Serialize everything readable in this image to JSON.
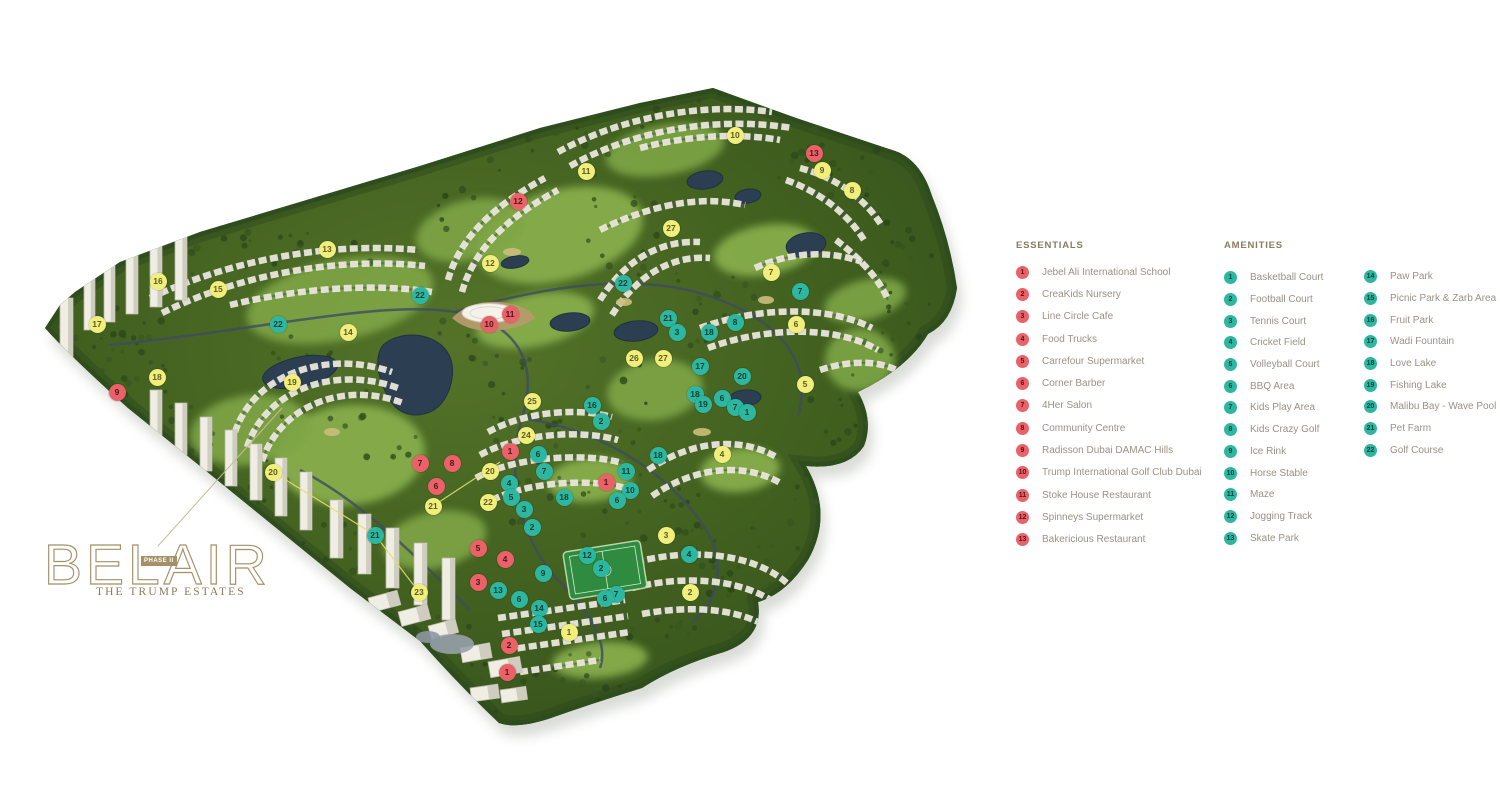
{
  "logo": {
    "name": "BELAIR",
    "phase": "PHASE II",
    "subtitle": "THE TRUMP ESTATES",
    "gold": "#a5906a",
    "subtitle_color": "#8d7a58"
  },
  "legend": {
    "header_color": "#8b7b5e",
    "essentials": {
      "title": "ESSENTIALS",
      "items": [
        {
          "n": "1",
          "label": "Jebel Ali International School"
        },
        {
          "n": "2",
          "label": "CreaKids Nursery"
        },
        {
          "n": "3",
          "label": "Line Circle Cafe"
        },
        {
          "n": "4",
          "label": "Food Trucks"
        },
        {
          "n": "5",
          "label": "Carrefour Supermarket"
        },
        {
          "n": "6",
          "label": "Corner Barber"
        },
        {
          "n": "7",
          "label": "4Her Salon"
        },
        {
          "n": "8",
          "label": "Community Centre"
        },
        {
          "n": "9",
          "label": "Radisson Dubai DAMAC Hills"
        },
        {
          "n": "10",
          "label": "Trump International Golf Club Dubai"
        },
        {
          "n": "11",
          "label": "Stoke House Restaurant"
        },
        {
          "n": "12",
          "label": "Spinneys Supermarket"
        },
        {
          "n": "13",
          "label": "Bakericious Restaurant"
        }
      ]
    },
    "amenities": {
      "title": "AMENITIES",
      "col1": [
        {
          "n": "1",
          "label": "Basketball Court"
        },
        {
          "n": "2",
          "label": "Football Court"
        },
        {
          "n": "3",
          "label": "Tennis Court"
        },
        {
          "n": "4",
          "label": "Cricket Field"
        },
        {
          "n": "5",
          "label": "Volleyball Court"
        },
        {
          "n": "6",
          "label": "BBQ Area"
        },
        {
          "n": "7",
          "label": "Kids Play Area"
        },
        {
          "n": "8",
          "label": "Kids Crazy Golf"
        },
        {
          "n": "9",
          "label": "Ice Rink"
        },
        {
          "n": "10",
          "label": "Horse Stable"
        },
        {
          "n": "11",
          "label": "Maze"
        },
        {
          "n": "12",
          "label": "Jogging Track"
        },
        {
          "n": "13",
          "label": "Skate Park"
        }
      ],
      "col2": [
        {
          "n": "14",
          "label": "Paw Park"
        },
        {
          "n": "15",
          "label": "Picnic Park & Zarb Area"
        },
        {
          "n": "16",
          "label": "Fruit Park"
        },
        {
          "n": "17",
          "label": "Wadi Fountain"
        },
        {
          "n": "18",
          "label": "Love Lake"
        },
        {
          "n": "19",
          "label": "Fishing Lake"
        },
        {
          "n": "20",
          "label": "Malibu Bay - Wave Pool"
        },
        {
          "n": "21",
          "label": "Pet Farm"
        },
        {
          "n": "22",
          "label": "Golf Course"
        }
      ]
    }
  },
  "map": {
    "marker_styles": {
      "red": {
        "bg": "#ea6168",
        "fg": "#4c191d"
      },
      "teal": {
        "bg": "#2db7a1",
        "fg": "#093f38"
      },
      "yellow": {
        "bg": "#f1ee7d",
        "fg": "#5c5c1e"
      }
    },
    "markers": [
      {
        "t": "yellow",
        "n": "16",
        "x": 158,
        "y": 281
      },
      {
        "t": "yellow",
        "n": "15",
        "x": 218,
        "y": 289
      },
      {
        "t": "yellow",
        "n": "13",
        "x": 327,
        "y": 249
      },
      {
        "t": "yellow",
        "n": "14",
        "x": 348,
        "y": 332
      },
      {
        "t": "yellow",
        "n": "17",
        "x": 97,
        "y": 324
      },
      {
        "t": "yellow",
        "n": "18",
        "x": 157,
        "y": 377
      },
      {
        "t": "yellow",
        "n": "19",
        "x": 292,
        "y": 382
      },
      {
        "t": "yellow",
        "n": "20",
        "x": 273,
        "y": 472
      },
      {
        "t": "yellow",
        "n": "12",
        "x": 490,
        "y": 263
      },
      {
        "t": "yellow",
        "n": "11",
        "x": 586,
        "y": 171
      },
      {
        "t": "yellow",
        "n": "10",
        "x": 735,
        "y": 135
      },
      {
        "t": "yellow",
        "n": "9",
        "x": 822,
        "y": 170
      },
      {
        "t": "yellow",
        "n": "8",
        "x": 852,
        "y": 190
      },
      {
        "t": "yellow",
        "n": "27",
        "x": 671,
        "y": 228
      },
      {
        "t": "yellow",
        "n": "7",
        "x": 771,
        "y": 272
      },
      {
        "t": "yellow",
        "n": "6",
        "x": 796,
        "y": 324
      },
      {
        "t": "yellow",
        "n": "5",
        "x": 805,
        "y": 384
      },
      {
        "t": "yellow",
        "n": "26",
        "x": 634,
        "y": 358
      },
      {
        "t": "yellow",
        "n": "27",
        "x": 663,
        "y": 358
      },
      {
        "t": "yellow",
        "n": "25",
        "x": 532,
        "y": 401
      },
      {
        "t": "yellow",
        "n": "24",
        "x": 526,
        "y": 435
      },
      {
        "t": "yellow",
        "n": "4",
        "x": 722,
        "y": 454
      },
      {
        "t": "yellow",
        "n": "22",
        "x": 488,
        "y": 502
      },
      {
        "t": "yellow",
        "n": "21",
        "x": 433,
        "y": 506
      },
      {
        "t": "yellow",
        "n": "20",
        "x": 490,
        "y": 471
      },
      {
        "t": "yellow",
        "n": "23",
        "x": 419,
        "y": 592
      },
      {
        "t": "yellow",
        "n": "3",
        "x": 666,
        "y": 535
      },
      {
        "t": "yellow",
        "n": "2",
        "x": 690,
        "y": 592
      },
      {
        "t": "yellow",
        "n": "1",
        "x": 569,
        "y": 632
      },
      {
        "t": "teal",
        "n": "22",
        "x": 278,
        "y": 324
      },
      {
        "t": "teal",
        "n": "22",
        "x": 420,
        "y": 295
      },
      {
        "t": "teal",
        "n": "22",
        "x": 623,
        "y": 283
      },
      {
        "t": "teal",
        "n": "21",
        "x": 668,
        "y": 318
      },
      {
        "t": "teal",
        "n": "21",
        "x": 375,
        "y": 535
      },
      {
        "t": "teal",
        "n": "8",
        "x": 735,
        "y": 322
      },
      {
        "t": "teal",
        "n": "3",
        "x": 677,
        "y": 332
      },
      {
        "t": "teal",
        "n": "18",
        "x": 709,
        "y": 332
      },
      {
        "t": "teal",
        "n": "17",
        "x": 700,
        "y": 366
      },
      {
        "t": "teal",
        "n": "20",
        "x": 742,
        "y": 376
      },
      {
        "t": "teal",
        "n": "18",
        "x": 695,
        "y": 394
      },
      {
        "t": "teal",
        "n": "19",
        "x": 703,
        "y": 404
      },
      {
        "t": "teal",
        "n": "6",
        "x": 722,
        "y": 398
      },
      {
        "t": "teal",
        "n": "7",
        "x": 735,
        "y": 407
      },
      {
        "t": "teal",
        "n": "1",
        "x": 747,
        "y": 412
      },
      {
        "t": "teal",
        "n": "7",
        "x": 800,
        "y": 291
      },
      {
        "t": "teal",
        "n": "16",
        "x": 592,
        "y": 405
      },
      {
        "t": "teal",
        "n": "2",
        "x": 601,
        "y": 421
      },
      {
        "t": "teal",
        "n": "18",
        "x": 658,
        "y": 455
      },
      {
        "t": "teal",
        "n": "11",
        "x": 626,
        "y": 471
      },
      {
        "t": "teal",
        "n": "10",
        "x": 630,
        "y": 490
      },
      {
        "t": "teal",
        "n": "6",
        "x": 617,
        "y": 500
      },
      {
        "t": "teal",
        "n": "6",
        "x": 538,
        "y": 454
      },
      {
        "t": "teal",
        "n": "7",
        "x": 544,
        "y": 471
      },
      {
        "t": "teal",
        "n": "4",
        "x": 509,
        "y": 483
      },
      {
        "t": "teal",
        "n": "5",
        "x": 511,
        "y": 497
      },
      {
        "t": "teal",
        "n": "3",
        "x": 524,
        "y": 509
      },
      {
        "t": "teal",
        "n": "2",
        "x": 532,
        "y": 527
      },
      {
        "t": "teal",
        "n": "18",
        "x": 564,
        "y": 497
      },
      {
        "t": "teal",
        "n": "12",
        "x": 587,
        "y": 555
      },
      {
        "t": "teal",
        "n": "2",
        "x": 601,
        "y": 568
      },
      {
        "t": "teal",
        "n": "9",
        "x": 543,
        "y": 573
      },
      {
        "t": "teal",
        "n": "13",
        "x": 498,
        "y": 590
      },
      {
        "t": "teal",
        "n": "6",
        "x": 519,
        "y": 599
      },
      {
        "t": "teal",
        "n": "14",
        "x": 539,
        "y": 608
      },
      {
        "t": "teal",
        "n": "15",
        "x": 538,
        "y": 624
      },
      {
        "t": "teal",
        "n": "7",
        "x": 616,
        "y": 594
      },
      {
        "t": "teal",
        "n": "6",
        "x": 605,
        "y": 598
      },
      {
        "t": "teal",
        "n": "4",
        "x": 689,
        "y": 554
      },
      {
        "t": "red",
        "n": "9",
        "x": 117,
        "y": 392
      },
      {
        "t": "red",
        "n": "12",
        "x": 518,
        "y": 201
      },
      {
        "t": "red",
        "n": "13",
        "x": 814,
        "y": 153
      },
      {
        "t": "red",
        "n": "10",
        "x": 489,
        "y": 324
      },
      {
        "t": "red",
        "n": "11",
        "x": 510,
        "y": 314
      },
      {
        "t": "red",
        "n": "7",
        "x": 420,
        "y": 463
      },
      {
        "t": "red",
        "n": "8",
        "x": 452,
        "y": 463
      },
      {
        "t": "red",
        "n": "6",
        "x": 436,
        "y": 486
      },
      {
        "t": "red",
        "n": "1",
        "x": 510,
        "y": 451
      },
      {
        "t": "red",
        "n": "1",
        "x": 606,
        "y": 482
      },
      {
        "t": "red",
        "n": "5",
        "x": 478,
        "y": 548
      },
      {
        "t": "red",
        "n": "4",
        "x": 505,
        "y": 559
      },
      {
        "t": "red",
        "n": "3",
        "x": 478,
        "y": 582
      },
      {
        "t": "red",
        "n": "2",
        "x": 509,
        "y": 645
      },
      {
        "t": "red",
        "n": "1",
        "x": 507,
        "y": 672
      }
    ]
  }
}
